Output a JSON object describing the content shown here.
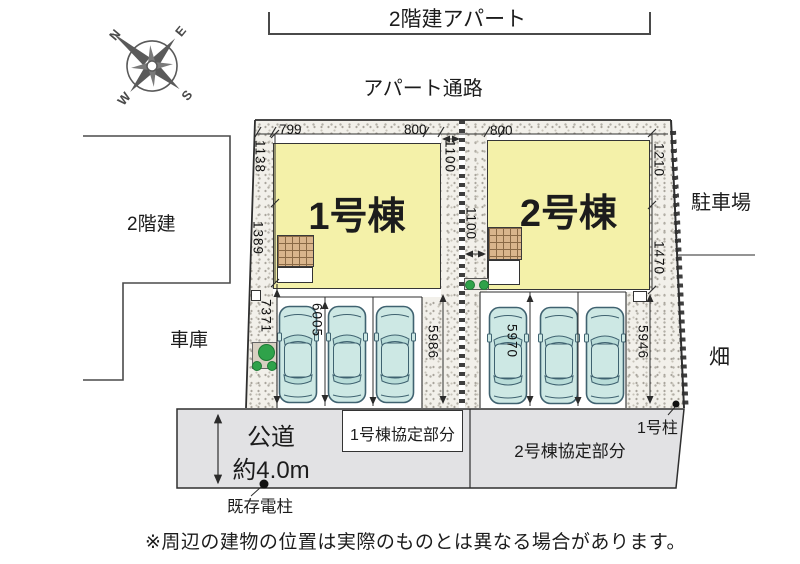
{
  "title": "区画図（配置図）",
  "surroundings": {
    "apartment_top": "2階建アパート",
    "passage": "アパート通路",
    "neighbor_left": "2階建",
    "garage": "車庫",
    "parking_lot_right": "駐車場",
    "field_right": "畑"
  },
  "compass": {
    "n": "N",
    "e": "E",
    "s": "S",
    "w": "W"
  },
  "buildings": {
    "b1": "1号棟",
    "b2": "2号棟"
  },
  "dims": {
    "d799": "799",
    "d800a": "800",
    "d800b": "800",
    "d1138": "1138",
    "d1389": "1389",
    "d7371": "7371",
    "d1100a": "1100",
    "d1100b": "1100",
    "d1210": "1210",
    "d1470": "1470",
    "d6005": "6005",
    "d5986": "5986",
    "d5970": "5970",
    "d5946": "5946"
  },
  "road": {
    "name": "公道",
    "width_note": "約4.0m",
    "agreement1": "1号棟協定部分",
    "agreement2": "2号棟協定部分",
    "pole": "既存電柱",
    "post": "1号柱"
  },
  "footer": {
    "disclaimer": "※周辺の建物の位置は実際のものとは異なる場合があります。"
  },
  "colors": {
    "building_fill": "#f4f1a9",
    "stipple_bg": "#f2f0ea",
    "road_fill": "#e2e2e4",
    "car_fill": "#cde8e4",
    "porch_fill": "#d9b58c",
    "tree_green": "#2fa24a"
  }
}
